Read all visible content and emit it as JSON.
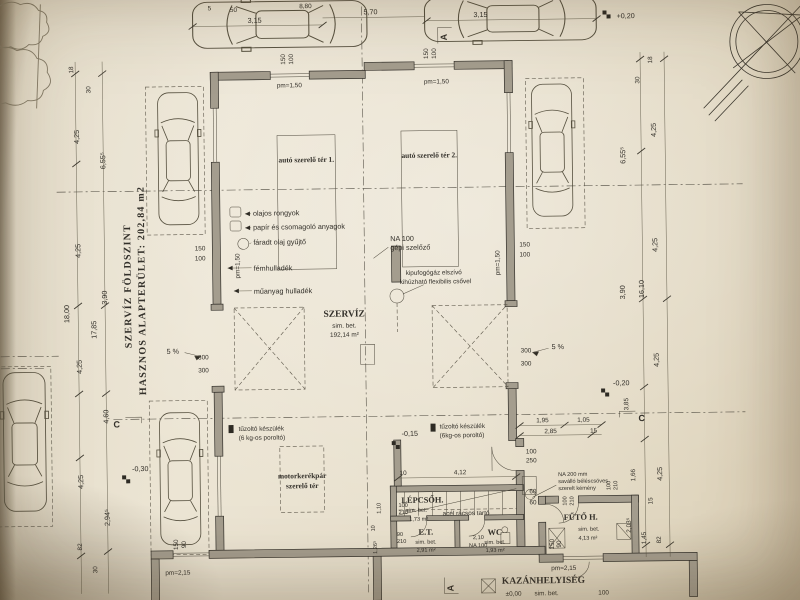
{
  "sheet": {
    "side_title_1": "SZERVÍZ FÖLDSZINT",
    "side_title_2": "HASZNOS ALAPTERÜLET: 202,84 m2"
  },
  "rooms": {
    "bay1": "autó szerelő tér 1.",
    "bay2": "autó szerelő tér 2.",
    "szerviz_name": "SZERVÍZ",
    "szerviz_finish": "sim. bet.",
    "szerviz_area": "192,14 m²",
    "moto_1": "motorkerékpár",
    "moto_2": "szerelő tér",
    "lepcso_name": "LÉPCSŐH.",
    "lepcso_finish": "sim. bet.",
    "lepcso_area": "1,73 m²",
    "et_name": "E.T.",
    "et_finish": "sim. bet.",
    "et_area": "2,91 m²",
    "wc_name": "WC",
    "wc_finish": "sim. bet.",
    "wc_area": "1,93 m²",
    "futo_name": "FŰTŐ H.",
    "futo_finish": "sim. bet.",
    "futo_area": "4,13 m²",
    "kazan_name": "KAZÁNHELYISÉG",
    "kazan_level": "±0,00",
    "kazan_finish": "sim. bet."
  },
  "annotations": {
    "waste_1": "olajos rongyok",
    "waste_2": "papír és csomagoló anyagok",
    "waste_3": "fáradt olaj gyűjtő",
    "waste_4": "fémhulladék",
    "waste_5": "műanyag hulladék",
    "vent_1": "NA 100",
    "vent_2": "gépi szelőző",
    "exhaust_1": "kipufogógáz elszívó",
    "exhaust_2": "kihúzható flexibilis csővel",
    "ext1_1": "tűzoltó készülék",
    "ext1_2": "(6 kg-os poroltó)",
    "ext2_1": "tűzoltó készülék",
    "ext2_2": "(6kg-os poroltó)",
    "truss": "acél rácsos tartó",
    "chimney_1": "NA 200 mm",
    "chimney_2": "saválló béléscsöves",
    "chimney_3": "szerelt kémény",
    "ramp_left": "5 %",
    "ramp_right": "5 %",
    "wc_vent": "NA 100"
  },
  "levels": {
    "top_right": "+0,20",
    "mid": "-0,15",
    "right": "-0,20",
    "left": "-0,30"
  },
  "sections": {
    "a_top": "A",
    "a_bottom": "A",
    "c_left": "C",
    "c_right": "C"
  },
  "dims": {
    "top_315_l": "3,15",
    "top_570": "5,70",
    "top_315_r": "3,15",
    "top_5": "5",
    "top_50": "50",
    "top_880": "8,80",
    "pm150_t1": "pm=1,50",
    "pm150_t2": "pm=1,50",
    "pm150_lw": "pm=1,50",
    "pm150_rw": "pm=1,50",
    "pm215_bl": "pm=2,15",
    "pm215_br": "pm=2,15",
    "win_t1_a": "150",
    "win_t1_b": "100",
    "win_t2_a": "150",
    "win_t2_b": "100",
    "win_l_a": "150",
    "win_l_b": "100",
    "win_r_a": "150",
    "win_r_b": "100",
    "win_bl_a": "150",
    "win_bl_b": "90",
    "win_br_a": "150",
    "win_br_b": "90",
    "gate_l_a": "300",
    "gate_l_b": "300",
    "gate_r_a": "300",
    "gate_r_b": "300",
    "l_18": "18",
    "l_30": "30",
    "l_425a": "4,25",
    "l_655": "6,55⁵",
    "l_425b": "4,25",
    "l_390": "3,90",
    "l_1800": "18,00",
    "l_1785": "17,85",
    "l_425c": "4,25",
    "l_460": "4,60",
    "l_425d": "4,25",
    "l_2945": "2,94⁵",
    "l_82": "82",
    "l_30b": "30",
    "r_18": "18",
    "r_30": "30",
    "r_425a": "4,25",
    "r_655": "6,55⁵",
    "r_425b": "4,25",
    "r_390": "3,90",
    "r_1610": "16,10",
    "r_425c": "4,25",
    "r_385": "3,85",
    "r_166": "1,66",
    "r_425d": "4,25",
    "r_15": "15",
    "r_2035": "2,03⁵",
    "r_145": "1,45",
    "r_82": "82",
    "i_195": "1,95",
    "i_105": "1,05",
    "i_285": "2,85",
    "i_15": "15",
    "i_100": "100",
    "i_250": "250",
    "i_60a": "60",
    "i_60b": "60",
    "i_412": "4,12",
    "i_10": "10",
    "d_100a": "100",
    "d_210a": "210",
    "d_90": "90",
    "d_210b": "210",
    "i_110": "1,10",
    "i_10b": "10",
    "i_1265": "1,26⁵",
    "i_210wc": "2,10",
    "fd_100a": "100",
    "fd_210a": "210",
    "fd_100b": "100",
    "fd_210b": "210",
    "kaz_100": "100"
  }
}
